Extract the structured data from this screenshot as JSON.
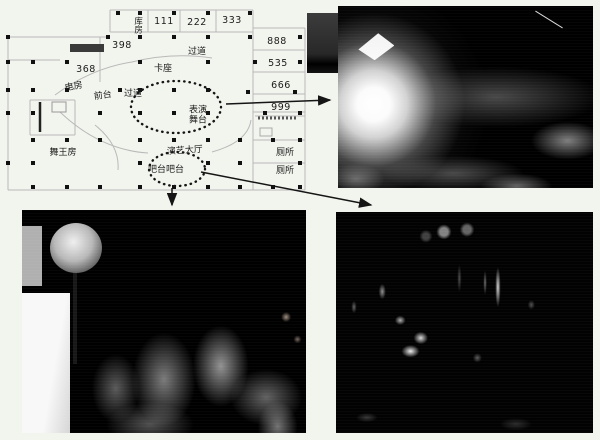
{
  "figure": {
    "description_visible_text_only": "",
    "background_color": "#f2f5ee"
  },
  "colors": {
    "plan_wall": "#b9b9b9",
    "plan_dot": "#111111",
    "arrow": "#151515",
    "label_text": "#1b1b1b",
    "photo_base": "#000000"
  },
  "plan": {
    "labels": {
      "storeroom": "库房",
      "room_111": "111",
      "room_222": "222",
      "room_333": "333",
      "room_398": "398",
      "corridor_top": "过道",
      "room_888": "888",
      "room_368": "368",
      "card_seats": "卡座",
      "room_535": "535",
      "electric_room": "电房",
      "front_desk": "前台",
      "corridor_mid": "过道",
      "room_666": "666",
      "performance_stage": "表演舞台",
      "room_999": "999",
      "dance_king_room": "舞王房",
      "performance_hall": "演艺大厅",
      "toilet_upper": "厕所",
      "bar_counter": "吧台吧台",
      "toilet_lower": "厕所"
    }
  }
}
